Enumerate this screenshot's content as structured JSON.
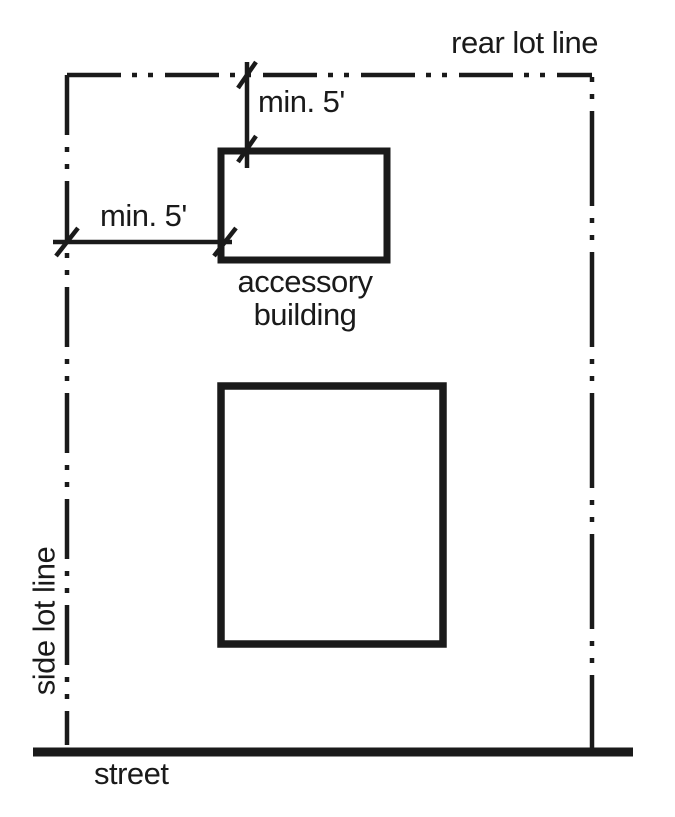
{
  "diagram": {
    "type": "zoning-setback-site-plan",
    "labels": {
      "rear_lot_line": "rear lot line",
      "side_lot_line": "side lot line",
      "street": "street",
      "accessory_building_line1": "accessory",
      "accessory_building_line2": "building",
      "rear_setback": "min. 5'",
      "side_setback": "min. 5'"
    },
    "buildings": {
      "accessory_building": "accessory building",
      "principal_building": ""
    },
    "setbacks": {
      "rear_setback_value": "min. 5'",
      "side_setback_value": "min. 5'"
    },
    "colors": {
      "ink": "#1a1a1a",
      "background": "#ffffff"
    }
  }
}
